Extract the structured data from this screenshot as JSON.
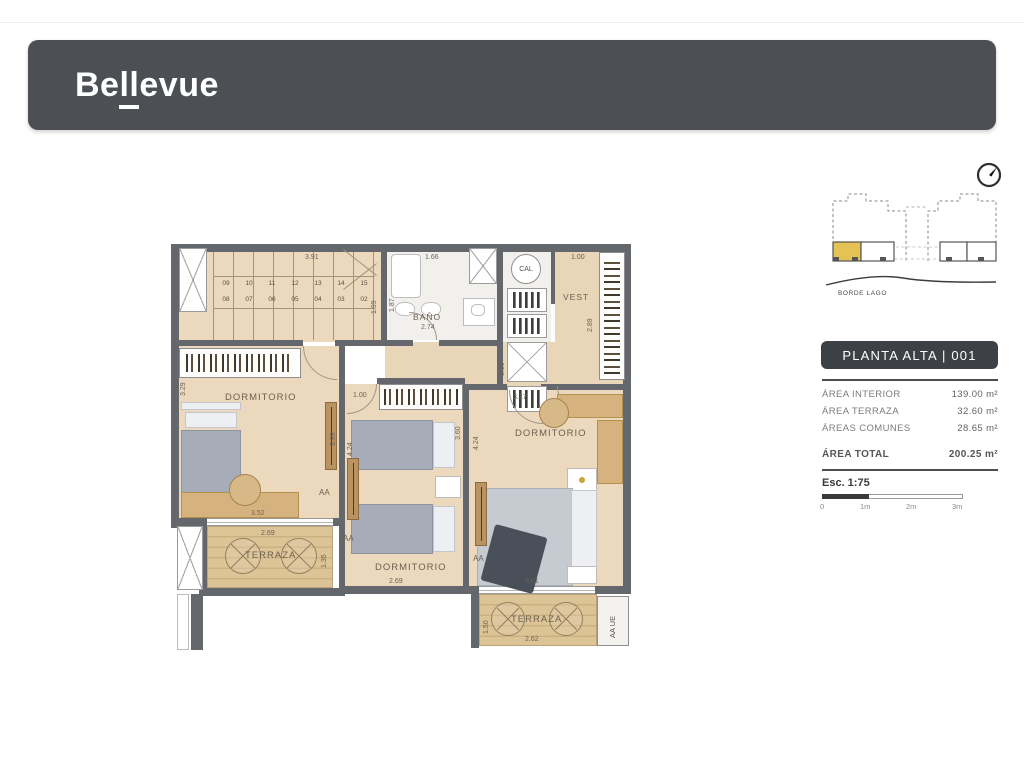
{
  "header": {
    "logo_pre": "Be",
    "logo_ll": "ll",
    "logo_post": "evue"
  },
  "sidebar": {
    "borde_lago": "BORDE LAGO",
    "badge": "PLANTA ALTA | 001",
    "areas": [
      {
        "label": "ÁREA INTERIOR",
        "value": "139.00 m²"
      },
      {
        "label": "ÁREA TERRAZA",
        "value": "32.60 m²"
      },
      {
        "label": "ÁREAS COMUNES",
        "value": "28.65 m²"
      }
    ],
    "total_label": "ÁREA TOTAL",
    "total_value": "200.25 m²",
    "scale_label": "Esc. 1:75",
    "scale_ticks": [
      "0",
      "1m",
      "2m",
      "3m"
    ]
  },
  "plan": {
    "stairs_top": [
      "09",
      "10",
      "11",
      "12",
      "13",
      "14",
      "15"
    ],
    "stairs_bottom": [
      "08",
      "07",
      "06",
      "05",
      "04",
      "03",
      "02"
    ],
    "rooms": {
      "bano": "BAÑO",
      "vest": "VEST",
      "cal": "CAL",
      "dorm1": "DORMITORIO",
      "dorm2": "DORMITORIO",
      "dorm3": "DORMITORIO",
      "terr1": "TERRAZA",
      "terr2": "TERRAZA"
    },
    "units": {
      "aa1": "AA",
      "aa2": "AA",
      "aa3": "AA",
      "aaue": "AA UE"
    },
    "dims": {
      "d391": "3.91",
      "d199": "1.99",
      "d166": "1.66",
      "d187": "1.87",
      "d274": "2.74",
      "d100v": "1.00",
      "d289": "2.89",
      "d090": "0.90",
      "d317": "3.17",
      "d329": "3.29",
      "d399": "3.99",
      "d424a": "4.24",
      "d424b": "4.24",
      "d100d": "1.00",
      "d360": "3.60",
      "d352": "3.52",
      "d269a": "2.69",
      "d269b": "2.69",
      "d135": "1.35",
      "d301": "3.01",
      "d262": "2.62",
      "d150": "1.50"
    }
  }
}
